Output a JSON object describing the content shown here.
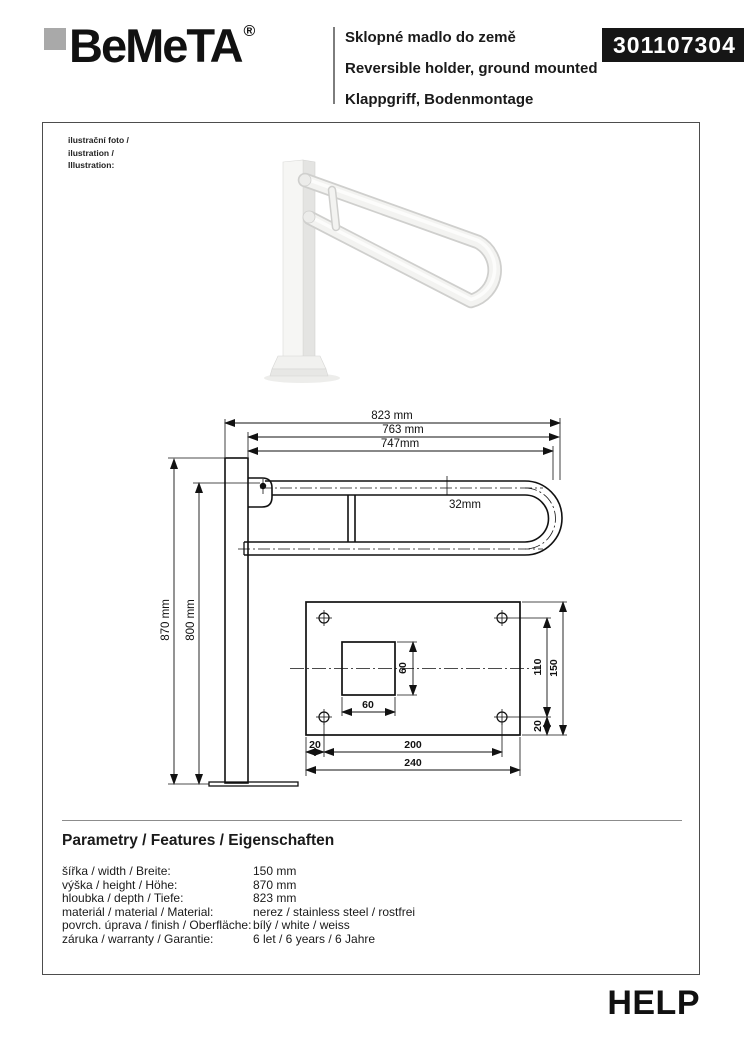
{
  "header": {
    "brand": "BeMeTA",
    "registered_mark": "®",
    "title_cs": "Sklopné madlo do země",
    "title_en": "Reversible holder, ground mounted",
    "title_de": "Klappgriff, Bodenmontage",
    "product_code": "301107304"
  },
  "illustration": {
    "label_cs": "ilustrační foto /",
    "label_en": "ilustration /",
    "label_de": "Illustration:"
  },
  "drawing": {
    "dim_total_length": "823 mm",
    "dim_arm_length": "763 mm",
    "dim_inner_length": "747mm",
    "dim_tube_diameter": "32mm",
    "dim_total_height": "870 mm",
    "dim_mount_height": "800 mm",
    "plate": {
      "square_width": "60",
      "square_height": "60",
      "holes_vertical_spacing": "110",
      "plate_height": "150",
      "hole_edge_offset_vertical": "20",
      "hole_edge_offset_horizontal": "20",
      "holes_horizontal_spacing": "200",
      "plate_width": "240"
    }
  },
  "parameters": {
    "heading": "Parametry / Features / Eigenschaften",
    "rows": [
      {
        "label": "šířka / width / Breite:",
        "value": "150 mm"
      },
      {
        "label": "výška / height / Höhe:",
        "value": "870 mm"
      },
      {
        "label": "hloubka / depth / Tiefe:",
        "value": "823 mm"
      },
      {
        "label": "materiál / material / Material:",
        "value": "nerez / stainless steel / rostfrei"
      },
      {
        "label": "povrch. úprava / finish / Oberfläche:",
        "value": "bílý / white / weiss"
      },
      {
        "label": "záruka / warranty / Garantie:",
        "value": "6 let / 6 years / 6 Jahre"
      }
    ]
  },
  "footer": {
    "series_name": "HELP"
  }
}
